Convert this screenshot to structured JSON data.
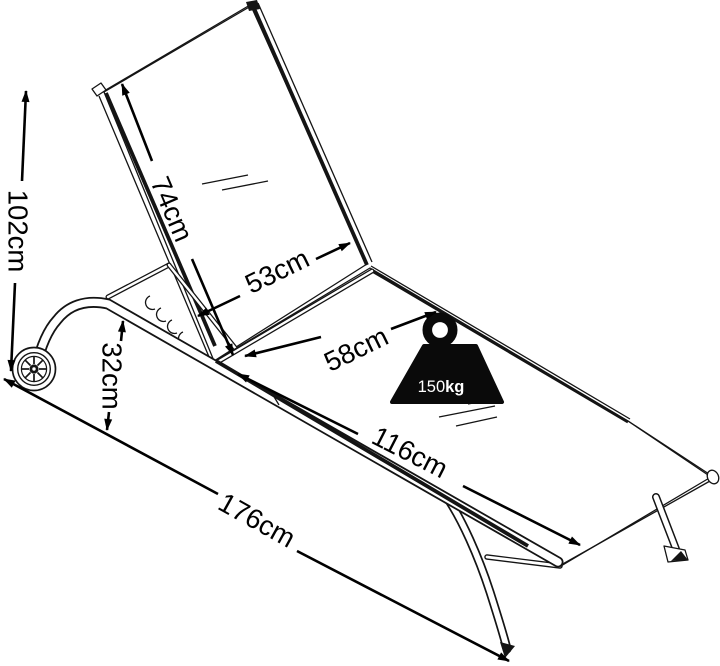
{
  "diagram": {
    "type": "product-dimension-diagram",
    "subject": "wheeled sun lounger with adjustable backrest",
    "colors": {
      "background": "#ffffff",
      "drawing_line": "#141414",
      "dimension_line": "#000000",
      "weight_icon_fill": "#0a0a0a",
      "weight_icon_text": "#ffffff"
    },
    "dimensions": {
      "total_height": "102cm",
      "backrest_length": "74cm",
      "backrest_width": "53cm",
      "seat_width": "58cm",
      "seat_length": "116cm",
      "frame_height": "32cm",
      "total_length": "176cm"
    },
    "weight_capacity": {
      "value": "150",
      "unit": "kg"
    }
  }
}
